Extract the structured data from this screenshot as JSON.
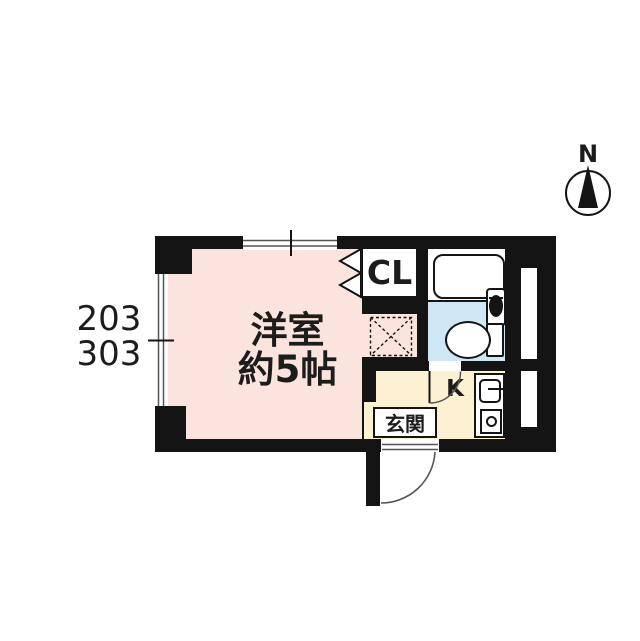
{
  "floor_plan": {
    "unit_number_top": "203",
    "unit_number_bottom": "303",
    "compass": {
      "north_label": "N"
    },
    "rooms": {
      "main_room": {
        "name": "洋室",
        "size": "約5帖"
      },
      "closet": {
        "label": "CL"
      },
      "kitchen": {
        "label": "K"
      },
      "entrance": {
        "label": "玄関"
      }
    },
    "colors": {
      "wall": "#141414",
      "main_room_floor": "#fbe4dd",
      "toilet_floor": "#cfe7f5",
      "kitchen_floor": "#fcf1d3",
      "window_line": "#555555",
      "door_arc": "#555555",
      "text": "#1c1c1c"
    }
  }
}
